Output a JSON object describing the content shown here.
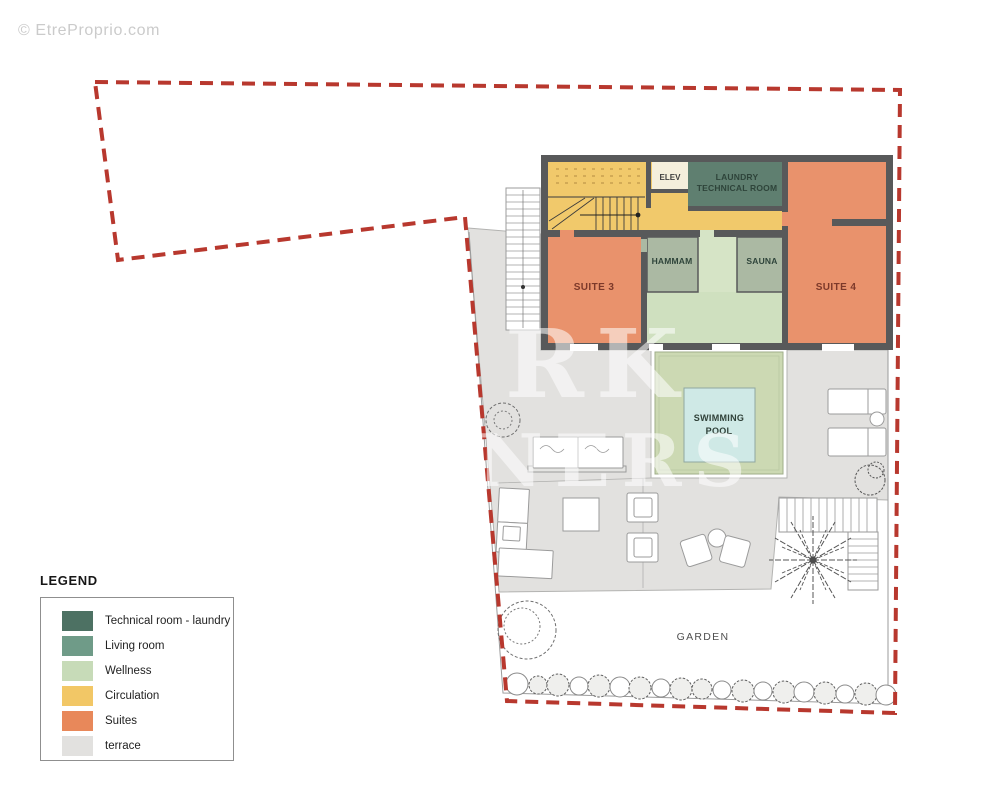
{
  "site_credit": "© EtreProprio.com",
  "agency_watermark": {
    "line1": "RK",
    "line2": "NERS"
  },
  "plan": {
    "boundary_color": "#b8382e",
    "wall_color": "#58595a",
    "terrace_color": "#e2e1df",
    "rooms": {
      "circulation": {
        "color": "#f1c96b"
      },
      "elev": {
        "label": "ELEV",
        "color": "#f5efdc"
      },
      "laundry": {
        "line1": "LAUNDRY",
        "line2": "TECHNICAL ROOM",
        "color": "#5f7f70"
      },
      "suite3": {
        "label": "SUITE 3",
        "color": "#e9926c"
      },
      "suite4": {
        "label": "SUITE 4",
        "color": "#e9926c"
      },
      "hammam": {
        "label": "HAMMAM",
        "color": "#abb9a3"
      },
      "sauna": {
        "label": "SAUNA",
        "color": "#abb9a3"
      },
      "wellness": {
        "color": "#cfe0bf",
        "corridor_color": "#d6e4c6"
      }
    },
    "outdoor": {
      "deck_color": "#ccd9b3",
      "pool": {
        "line1": "SWIMMING",
        "line2": "POOL",
        "color": "#cfe9e6"
      },
      "garden_label": "GARDEN"
    }
  },
  "legend": {
    "title": "LEGEND",
    "items": [
      {
        "label": "Technical room - laundry",
        "color": "#4d7163"
      },
      {
        "label": "Living room",
        "color": "#6f9b88"
      },
      {
        "label": "Wellness",
        "color": "#c7dbb8"
      },
      {
        "label": "Circulation",
        "color": "#f2c766"
      },
      {
        "label": "Suites",
        "color": "#e8885a"
      },
      {
        "label": "terrace",
        "color": "#e2e1df"
      }
    ]
  }
}
